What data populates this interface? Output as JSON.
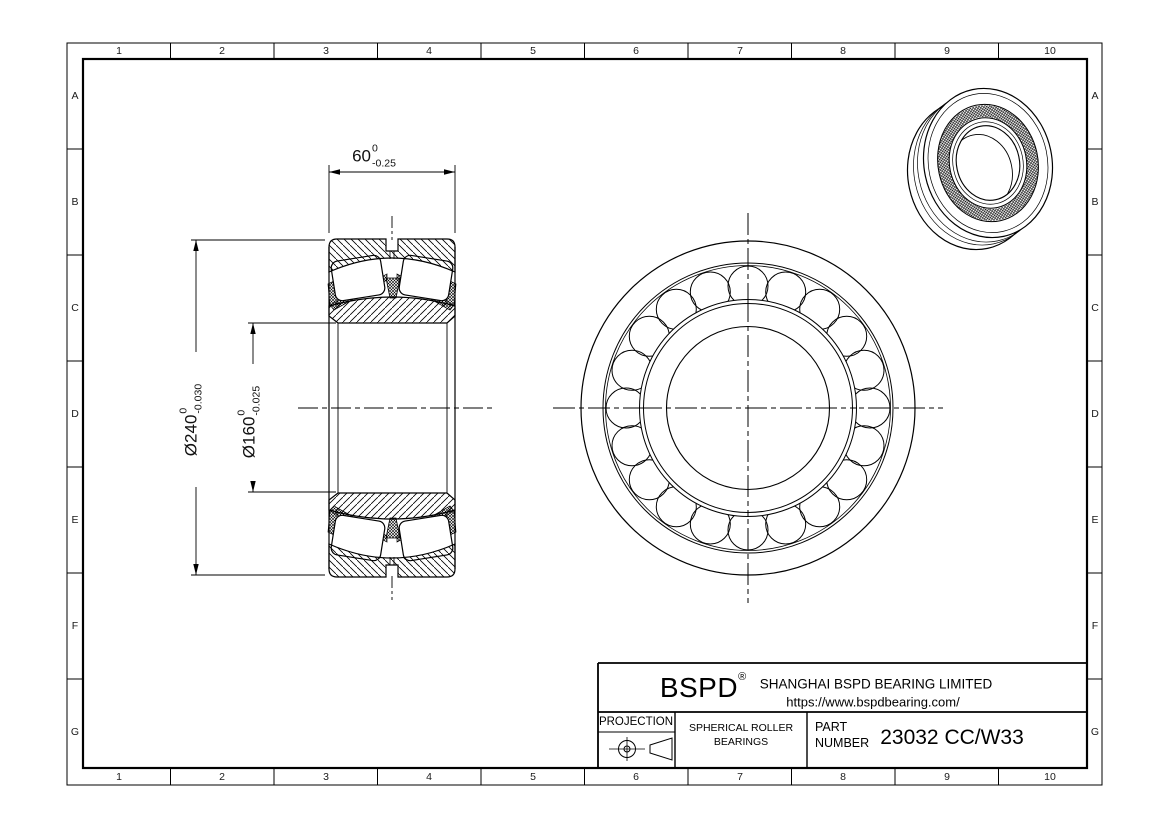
{
  "page": {
    "background": "#ffffff",
    "line_color": "#000000"
  },
  "border": {
    "columns": [
      "1",
      "2",
      "3",
      "4",
      "5",
      "6",
      "7",
      "8",
      "9",
      "10"
    ],
    "rows": [
      "A",
      "B",
      "C",
      "D",
      "E",
      "F",
      "G"
    ]
  },
  "dimensions": {
    "width": {
      "value": "60",
      "tol_upper": "0",
      "tol_lower": "-0.25"
    },
    "outer_diameter": {
      "value": "Ø240",
      "tol_upper": "0",
      "tol_lower": "-0.030"
    },
    "bore_diameter": {
      "value": "Ø160",
      "tol_upper": "0",
      "tol_lower": "-0.025"
    }
  },
  "title_block": {
    "logo": "BSPD",
    "registered_mark": "®",
    "company": "SHANGHAI BSPD BEARING LIMITED",
    "website": "https://www.bspdbearing.com/",
    "projection_label": "PROJECTION",
    "product_type_line1": "SPHERICAL ROLLER",
    "product_type_line2": "BEARINGS",
    "part_label_line1": "PART",
    "part_label_line2": "NUMBER",
    "part_number": "23032 CC/W33"
  }
}
